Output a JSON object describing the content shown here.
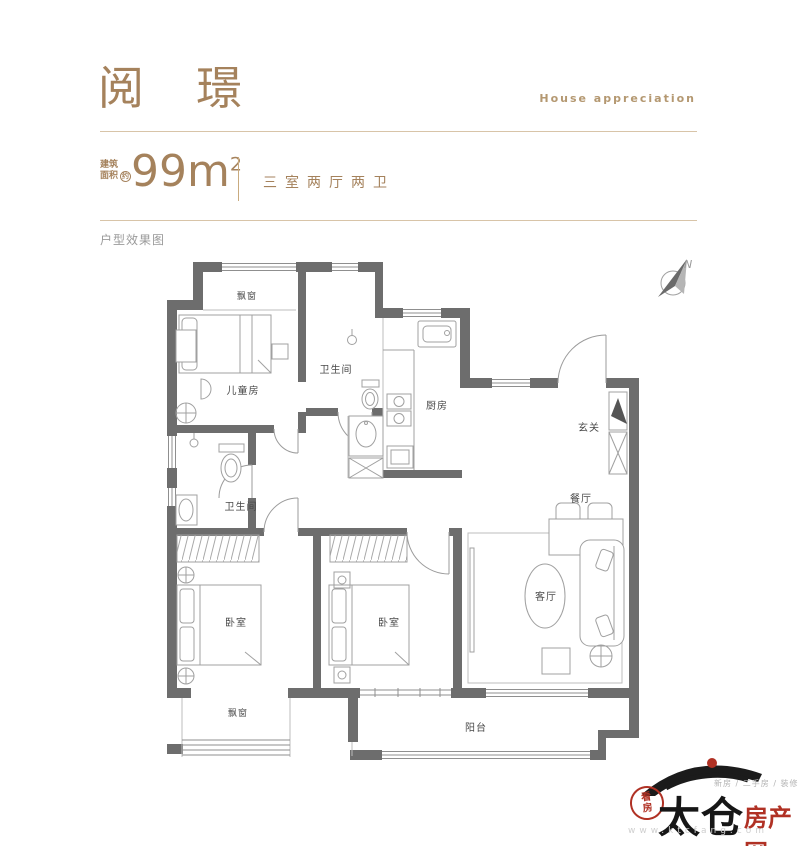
{
  "colors": {
    "accent": "#a5825c",
    "accent_light": "#b49871",
    "divider": "#d8c4a8",
    "wall": "#6d6d6d",
    "room_label": "#4a4a4a",
    "watermark_red": "#b03124"
  },
  "header": {
    "title": "阅璟",
    "subtitle_en": "House appreciation",
    "area_label_line1": "建筑",
    "area_label_line2": "面积",
    "area_approx": "约",
    "area_value": "99m",
    "area_sup": "2",
    "layout_text": "三室两厅两卫",
    "section_label": "户型效果图"
  },
  "floorplan": {
    "compass": {
      "label": "N"
    },
    "rooms": [
      {
        "id": "bay-window-top",
        "label": "飘窗"
      },
      {
        "id": "kids-room",
        "label": "儿童房"
      },
      {
        "id": "bathroom-upper",
        "label": "卫生间"
      },
      {
        "id": "kitchen",
        "label": "厨房"
      },
      {
        "id": "entry",
        "label": "玄关"
      },
      {
        "id": "dining",
        "label": "餐厅"
      },
      {
        "id": "living",
        "label": "客厅"
      },
      {
        "id": "bedroom-left",
        "label": "卧室"
      },
      {
        "id": "bedroom-middle",
        "label": "卧室"
      },
      {
        "id": "bathroom-lower",
        "label": "卫生间"
      },
      {
        "id": "bay-window-bottom",
        "label": "飘窗"
      },
      {
        "id": "balcony",
        "label": "阳台"
      }
    ]
  },
  "watermark": {
    "brand_black": "太仓",
    "brand_red": "房产网",
    "seal_text": "看房",
    "tagline": "新房 / 二手房 / 装修",
    "url": "www.ktcfang.com"
  }
}
